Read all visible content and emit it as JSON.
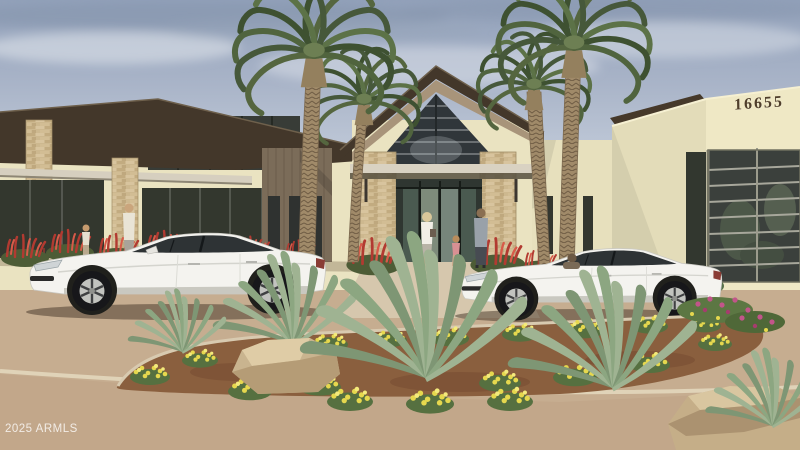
{
  "image": {
    "kind": "real-estate-listing-rendering",
    "subject": "Single-story modern clubhouse entrance with four palm trees, desert landscaping, two parked white sedans and five pedestrians",
    "watermark": "2025 ARMLS",
    "building_number": "16655"
  },
  "colors": {
    "sky_top": "#92a1ba",
    "sky_bottom": "#d5dce6",
    "roof_dark": "#43372a",
    "wall_cream": "#eae3c1",
    "wall_cream_front": "#efe8c5",
    "panel_taupe": "#7b6c59",
    "stone_tan": "#cdb88f",
    "glass_dark": "#363b36",
    "awning_grey": "#d6cfbf",
    "canopy_grey": "#d9d2c2",
    "palm_frond_dark": "#3e5131",
    "palm_frond_light": "#5c7247",
    "palm_trunk": "#a08a69",
    "car_white": "#f4f3ef",
    "pavement": "#c6ad90",
    "walkway": "#d6c7ad",
    "road": "#c2a78a",
    "curb": "#e0d3b8",
    "mulch": "#8a5f3e",
    "flower_yellow": "#e6d84e",
    "flower_red": "#b23a31",
    "flower_magenta": "#c2558a",
    "agave_green": "#9fb392",
    "rock_tan": "#c9b48f",
    "shrub_green": "#55743c"
  }
}
